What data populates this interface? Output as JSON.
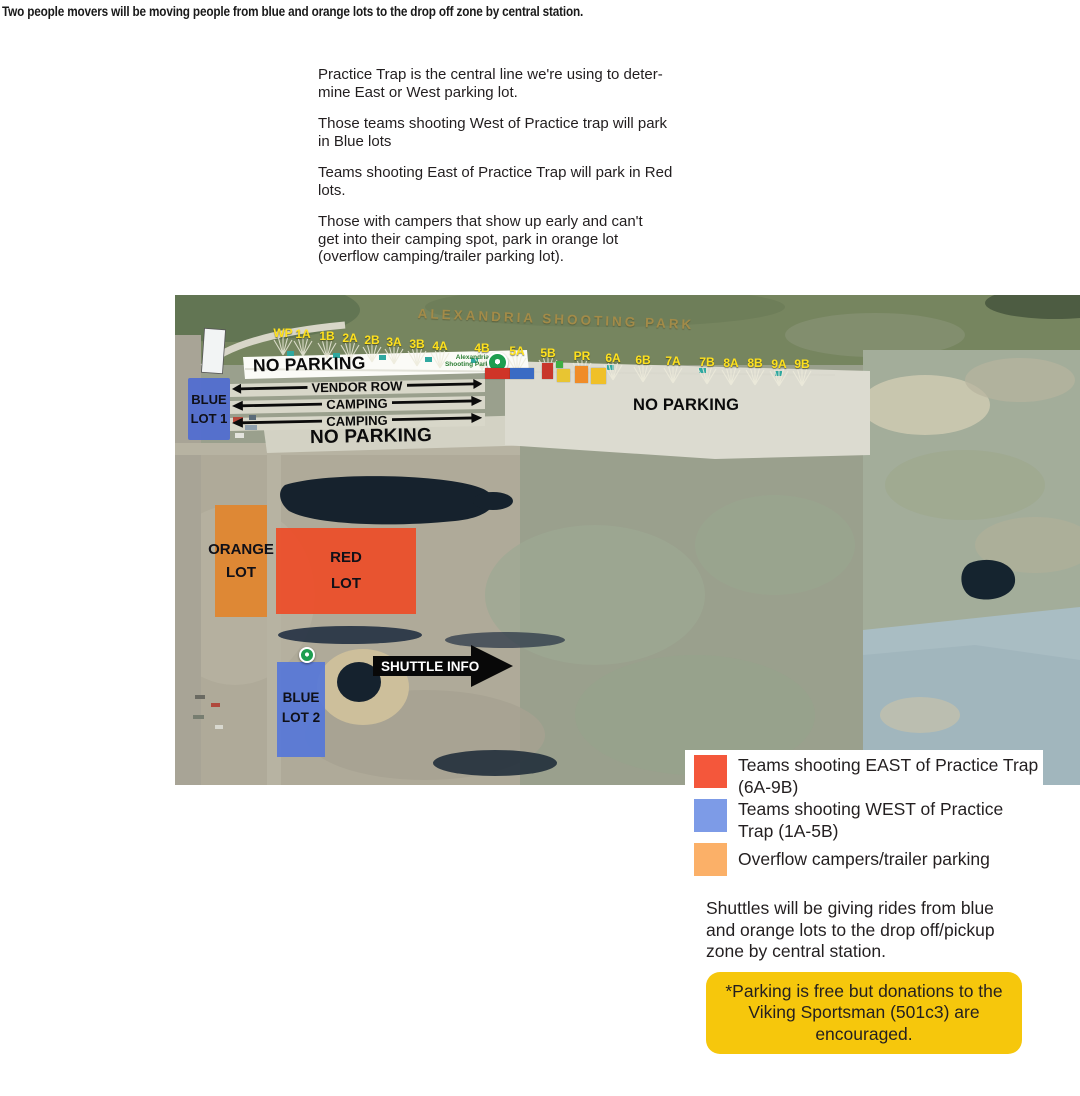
{
  "top_note": "Two people movers will be moving people from blue and orange lots to the drop off zone by central station.",
  "instructions": {
    "p1": "Practice Trap is the central line we're using to deter-\nmine East or West parking lot.",
    "p2": "Those teams shooting West of Practice trap will park\nin Blue lots",
    "p3": "Teams shooting East of Practice Trap will park in Red\nlots.",
    "p4": "Those with campers that show up early and can't\nget into their camping spot, park in orange lot\n(overflow camping/trailer parking lot)."
  },
  "map": {
    "park_title": "ALEXANDRIA SHOOTING PARK",
    "poi_label": "Alexandria Shooting Park",
    "stations": [
      "WP",
      "1A",
      "1B",
      "2A",
      "2B",
      "3A",
      "3B",
      "4A",
      "4B",
      "5A",
      "5B",
      "PR",
      "6A",
      "6B",
      "7A",
      "7B",
      "8A",
      "8B",
      "9A",
      "9B"
    ],
    "no_parking_top": "NO PARKING",
    "vendor_row": "VENDOR ROW",
    "camping_1": "CAMPING",
    "camping_2": "CAMPING",
    "no_parking_bottom": "NO PARKING",
    "no_parking_right": "NO PARKING",
    "blue_lot_1": "BLUE\nLOT 1",
    "orange_lot": "ORANGE\nLOT",
    "red_lot": "RED\nLOT",
    "blue_lot_2": "BLUE\nLOT 2",
    "shuttle_info": "SHUTTLE INFO",
    "station_label_color": "#ffe11e",
    "park_title_color": "#a68c48"
  },
  "panel": {
    "legend": [
      {
        "color": "#f4573b",
        "label": "Teams shooting EAST of Practice Trap\n(6A-9B)"
      },
      {
        "color": "#7d9be7",
        "label": "Teams shooting WEST of Practice\nTrap (1A-5B)"
      },
      {
        "color": "#fbb068",
        "label": "Overflow campers/trailer parking"
      }
    ],
    "shuttle_note": "Shuttles will be giving rides from blue\nand orange lots to the drop off/pickup\nzone by central station.",
    "donation_note": "*Parking is free but donations to the\nViking Sportsman (501c3) are\nencouraged.",
    "donation_bg": "#f6c70c"
  }
}
